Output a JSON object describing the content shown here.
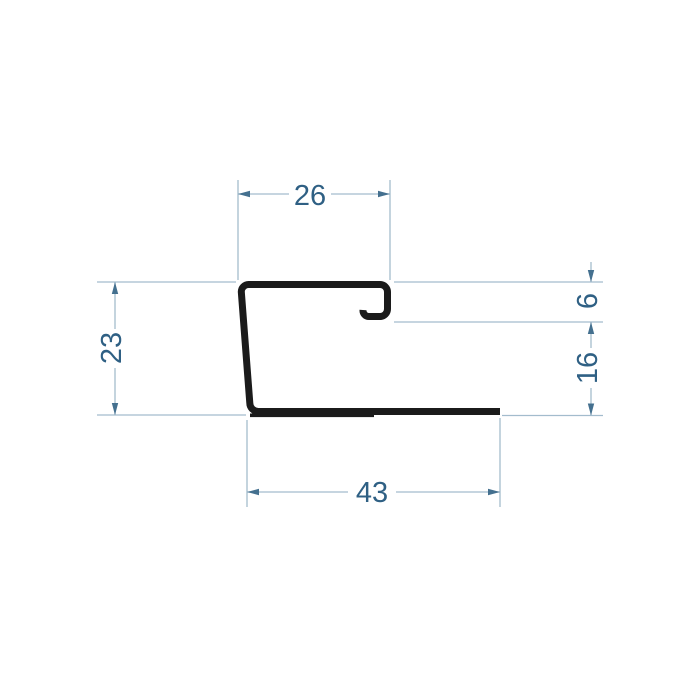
{
  "drawing": {
    "kind": "profile-cross-section-technical-drawing",
    "dimensions": {
      "top_width": "26",
      "left_height": "23",
      "lip_height": "6",
      "right_height": "16",
      "bottom_width": "43"
    },
    "colors": {
      "background": "#ffffff",
      "profile": "#1b1b1b",
      "dimension_line": "#a3bccd",
      "arrow": "#44708f",
      "text": "#2f6084"
    }
  }
}
